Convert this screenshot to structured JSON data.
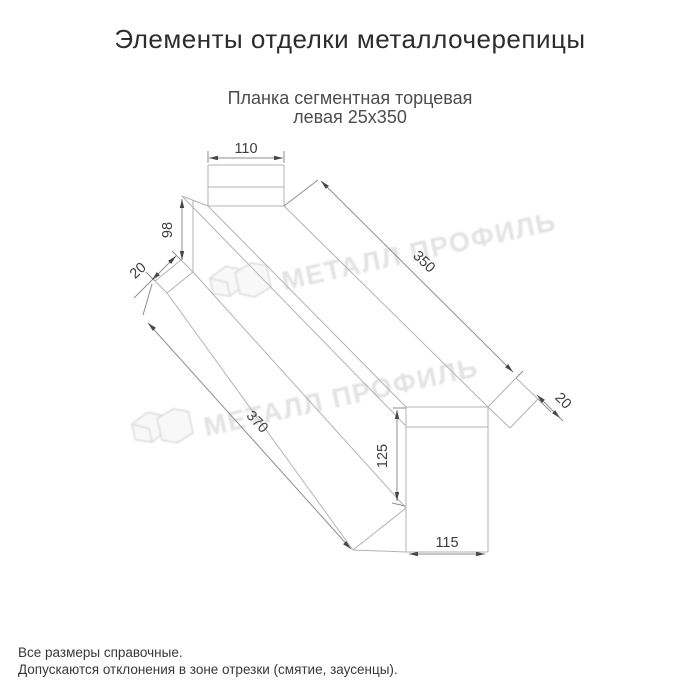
{
  "title": "Элементы отделки металлочерепицы",
  "subtitle": {
    "line1": "Планка сегментная торцевая",
    "line2": "левая 25х350"
  },
  "watermark": {
    "text": "МЕТАЛЛ ПРОФИЛЬ"
  },
  "drawing": {
    "product": "Планка сегментная торцевая левая 25х350",
    "dims": {
      "top_width": "110",
      "left_height": "98",
      "left_fold": "20",
      "length_top": "350",
      "right_fold": "20",
      "length_bottom": "370",
      "right_height": "125",
      "bottom_width": "115"
    }
  },
  "footnotes": {
    "line1": "Все размеры справочные.",
    "line2": "Допускаются отклонения в зоне отрезки (смятие, заусенцы)."
  },
  "colors": {
    "background": "#ffffff",
    "edge_line": "#b3b3b3",
    "dimension_line": "#8e8e8e",
    "text": "#2d2d2d",
    "watermark": "#e3e3e3"
  }
}
